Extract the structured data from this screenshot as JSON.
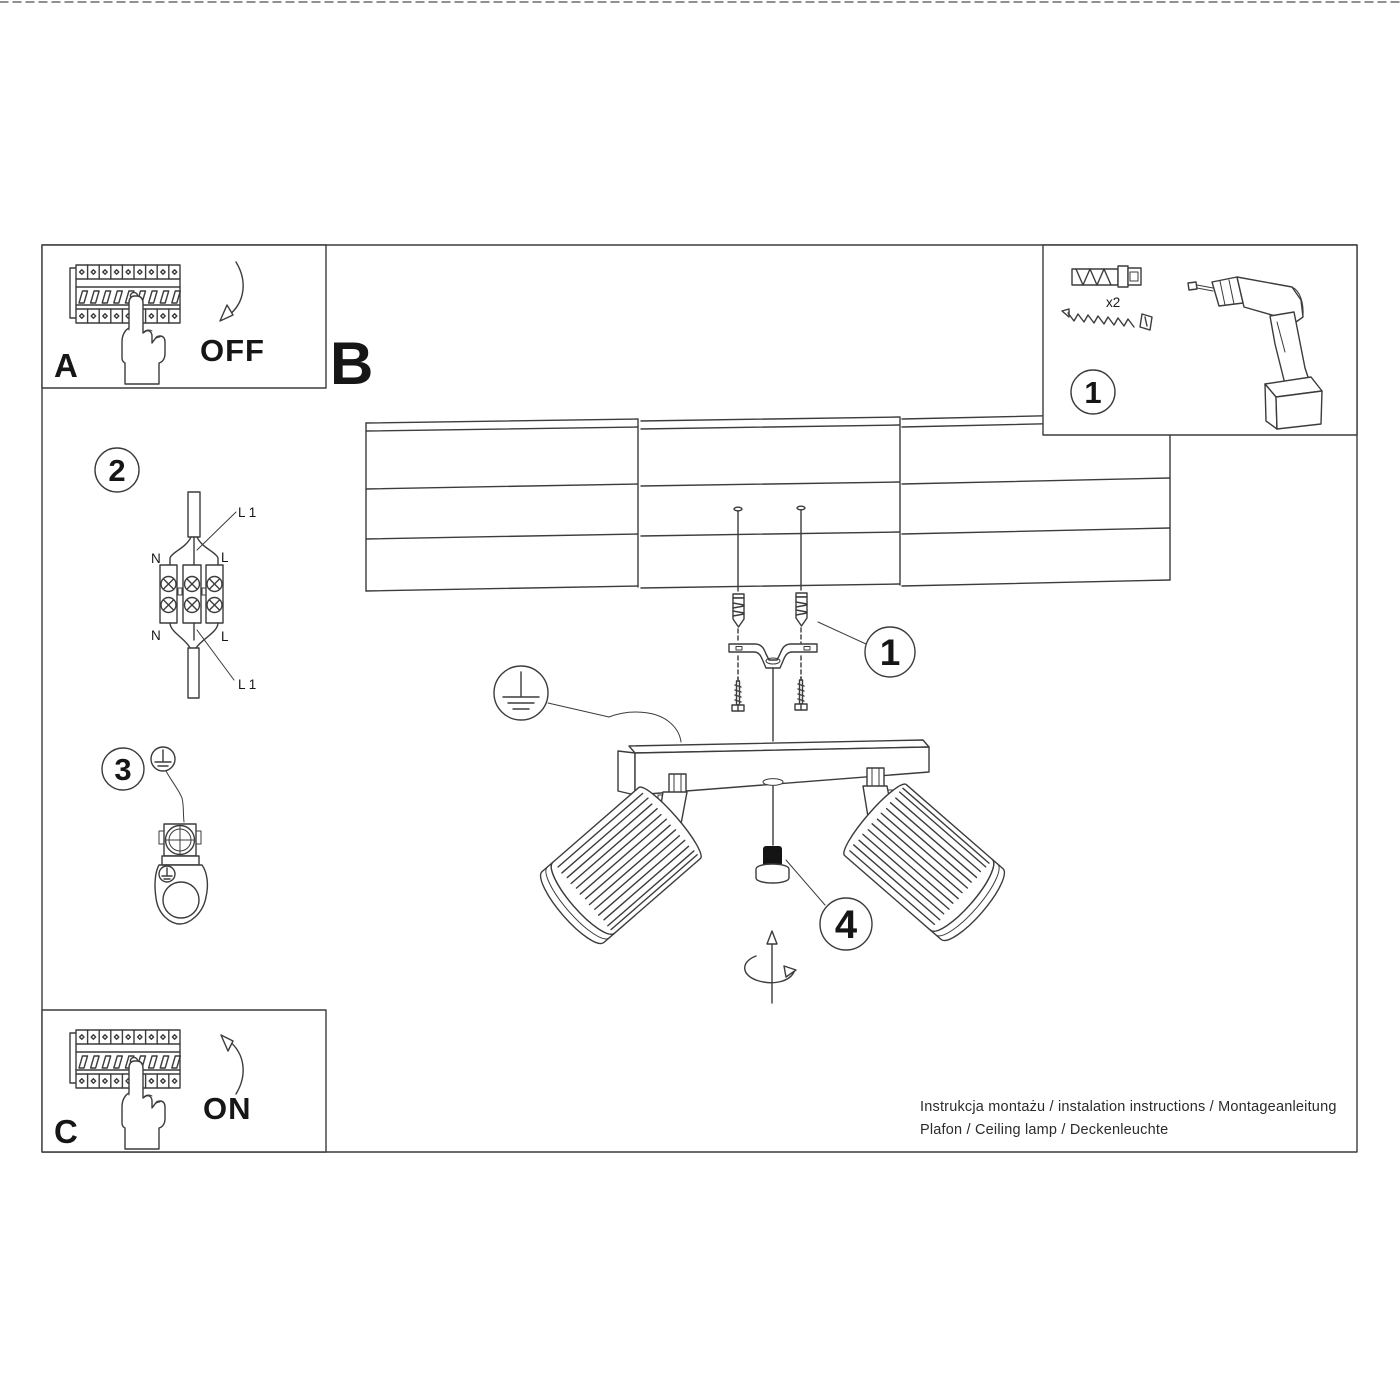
{
  "panels": {
    "a": {
      "letter": "A",
      "state": "OFF"
    },
    "b": {
      "letter": "B"
    },
    "c": {
      "letter": "C",
      "state": "ON"
    }
  },
  "parts_box": {
    "step_number": "1",
    "anchor_quantity": "x2"
  },
  "step_markers": {
    "anchors": "1",
    "wiring": "2",
    "ground": "3",
    "adjust": "4"
  },
  "wiring_labels": {
    "l1_top": "L 1",
    "n_top": "N",
    "l_top": "L",
    "n_bottom": "N",
    "l_bottom": "L",
    "l1_bottom": "L 1"
  },
  "footer": {
    "line1": "Instrukcja montażu / instalation instructions / Montageanleitung",
    "line2": "Plafon / Ceiling lamp / Deckenleuchte"
  },
  "colors": {
    "line": "#3c3c3c",
    "text": "#161616",
    "knob": "#141414"
  }
}
